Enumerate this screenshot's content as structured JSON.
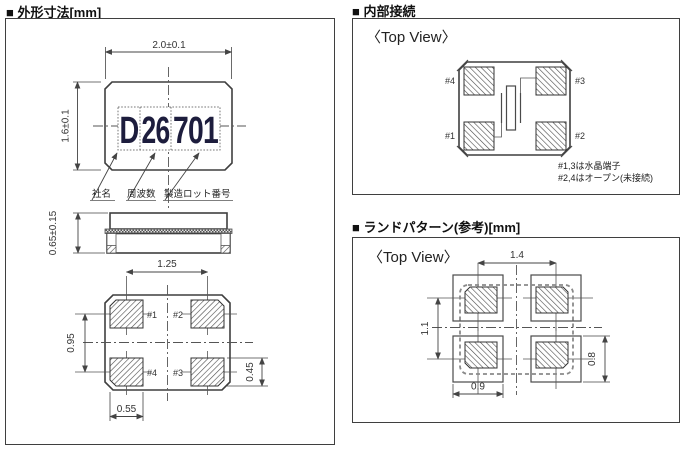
{
  "outline_panel": {
    "title": "■ 外形寸法[mm]",
    "top_view": {
      "width_dim": "2.0±0.1",
      "height_dim": "1.6±0.1",
      "marking_segments": [
        "D",
        "26",
        "701"
      ],
      "callouts": [
        "社名",
        "周波数",
        "製造ロット番号"
      ]
    },
    "side_view": {
      "thickness_dim": "0.65±0.15"
    },
    "bottom_view": {
      "pitch_x": "1.25",
      "pitch_y": "0.95",
      "pad_w": "0.55",
      "pad_h": "0.45",
      "pad_labels": {
        "top_left": "#1",
        "top_right": "#2",
        "bottom_left": "#4",
        "bottom_right": "#3"
      }
    }
  },
  "internal_panel": {
    "title": "■ 内部接続",
    "view_label": "〈Top View〉",
    "pad_labels": {
      "top_left": "#4",
      "top_right": "#3",
      "bottom_left": "#1",
      "bottom_right": "#2"
    },
    "notes": [
      "#1,3は水晶端子",
      "#2,4はオープン(未接続)"
    ]
  },
  "land_panel": {
    "title": "■ ランドパターン(参考)[mm]",
    "view_label": "〈Top View〉",
    "pitch_x": "1.4",
    "pitch_y": "1.1",
    "pad_w": "0.9",
    "pad_h": "0.8"
  }
}
